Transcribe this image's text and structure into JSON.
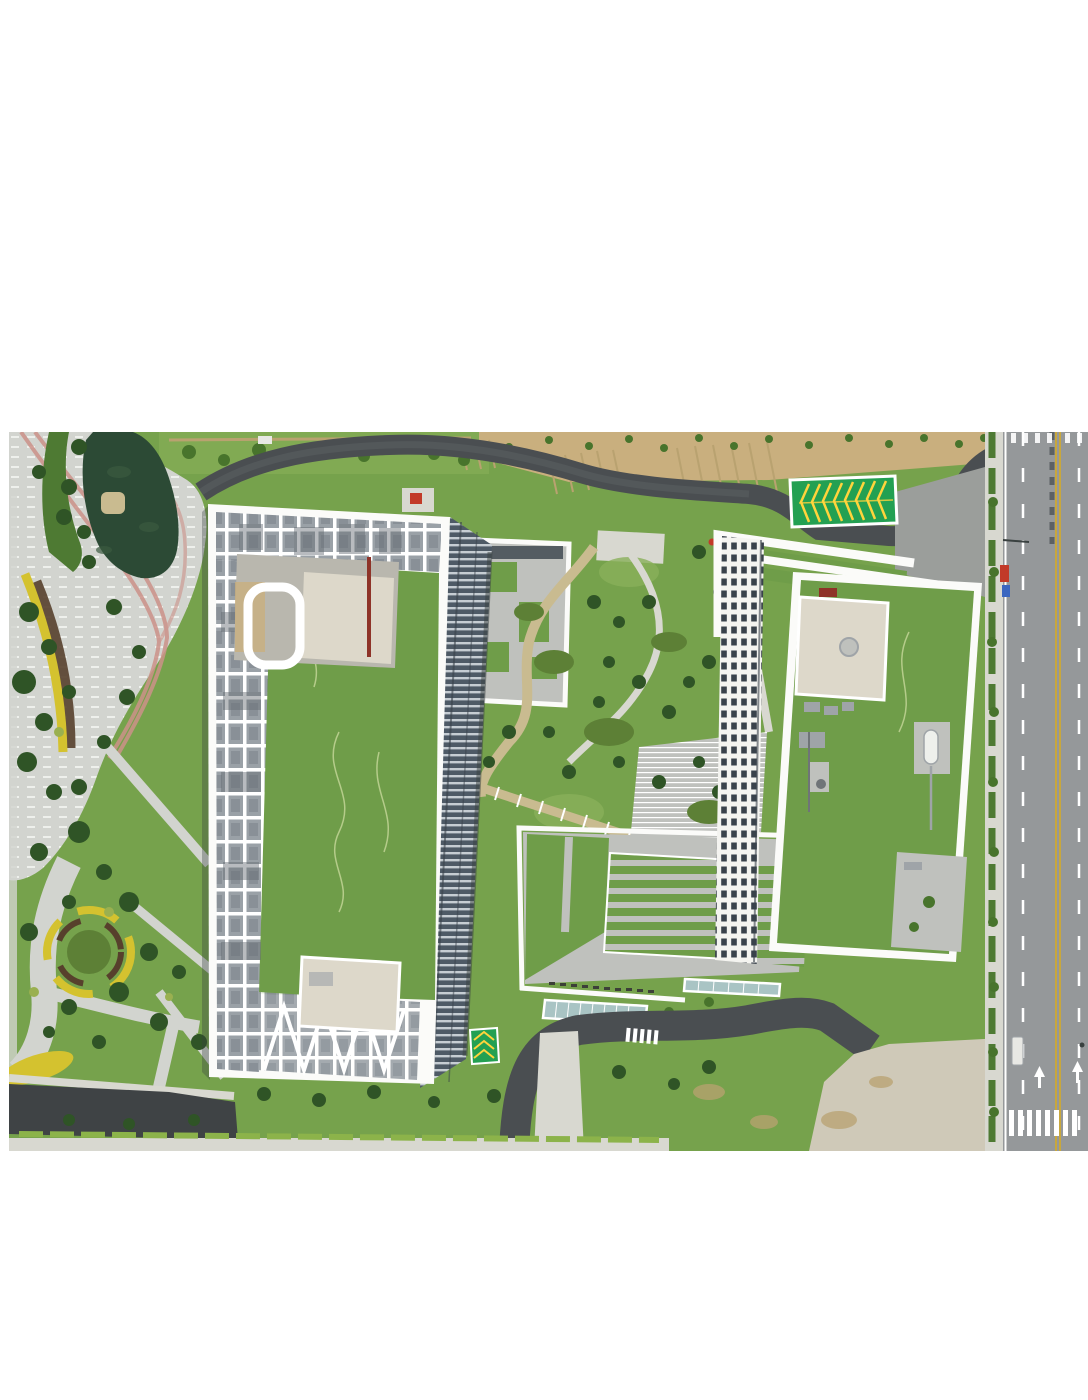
{
  "meta": {
    "description": "Top-down aerial drone photograph of two white high-rise buildings with rooftop lawns and pergola lattices, surrounded by a landscaped park with a pond, winding promenades, yellow flower beds, a green chevron-marked arrester pad, internal loop roads and a multi-lane city road on the right."
  },
  "scene": {
    "left_tower": "white tower roof with perimeter lattice, rooftop lawn, penthouse blocks and diagonal braces",
    "right_tower": "white slab building with green roof, cream penthouse, rooftop equipment and tank",
    "park": "lakeside park with striped promenade, pink jogging lanes, yellow flower arcs and trees",
    "pond": "dark green pond with small island",
    "chevron_pad": "green arrester pad with yellow chevron markings",
    "garden": "central courtyard garden with curved paths and terraced green strips",
    "main_road": "vertical multi-lane road with double yellow centerline, lane dashes, zebra crossings, arrows and parked vehicles",
    "bottom": "service drive, glass skylights, hedge row and pale plaza with crosswalk"
  },
  "colors": {
    "background": "#ffffff",
    "grass": "#76a24c",
    "grass_light": "#8ab05a",
    "lawn_roof": "#6f9d49",
    "lawn_squiggle": "#b5cc8a",
    "tree_dark": "#2f5426",
    "tree_mid": "#48742c",
    "shrub_olive": "#5d8036",
    "accent_green": "#9ab050",
    "bank_green": "#4e7a33",
    "pond": "#2c4a35",
    "pond_texture": "#3a5a40",
    "island_tan": "#c9bb90",
    "promenade": "#d2d4cf",
    "promenade_dash": "#eef0ec",
    "jog_pink": "#cc9289",
    "flower_yellow": "#d4c22f",
    "mulch": "#57402c",
    "dirt": "#c9af7e",
    "stall_tan": "#b9a270",
    "asphalt": "#4a4e51",
    "asphalt_center": "#5c6164",
    "dark_asphalt": "#3f4345",
    "road": "#95989a",
    "road_junction": "#9b9e9b",
    "plaza": "#cfc9b8",
    "sidewalk": "#d8d8d0",
    "hedge": "#8cb34a",
    "building_white": "#f4f4f0",
    "parapet": "#fbfbf9",
    "lattice": "#9aa1a7",
    "lattice_shadow": "#646b72",
    "cream": "#ddd8ca",
    "pent_gray": "#b9b7ae",
    "concrete": "#bfc1bd",
    "facade": "#4e5a66",
    "facade_slat": "#c6cdd3",
    "window": "#39424b",
    "shadow": "#3a4140",
    "chevron_green": "#23a052",
    "chevron_yellow": "#ffd43c",
    "glass": "#a9c4c4",
    "lane_yellow": "#c8a73d",
    "white": "#ffffff",
    "red": "#c23a28",
    "red_strip": "#8e3328",
    "blue": "#3a66c0",
    "truck_white": "#e8e8e4",
    "equip_gray": "#9fa4a8",
    "equip_dark": "#6f7478",
    "bench_dark": "#3c3f38"
  }
}
